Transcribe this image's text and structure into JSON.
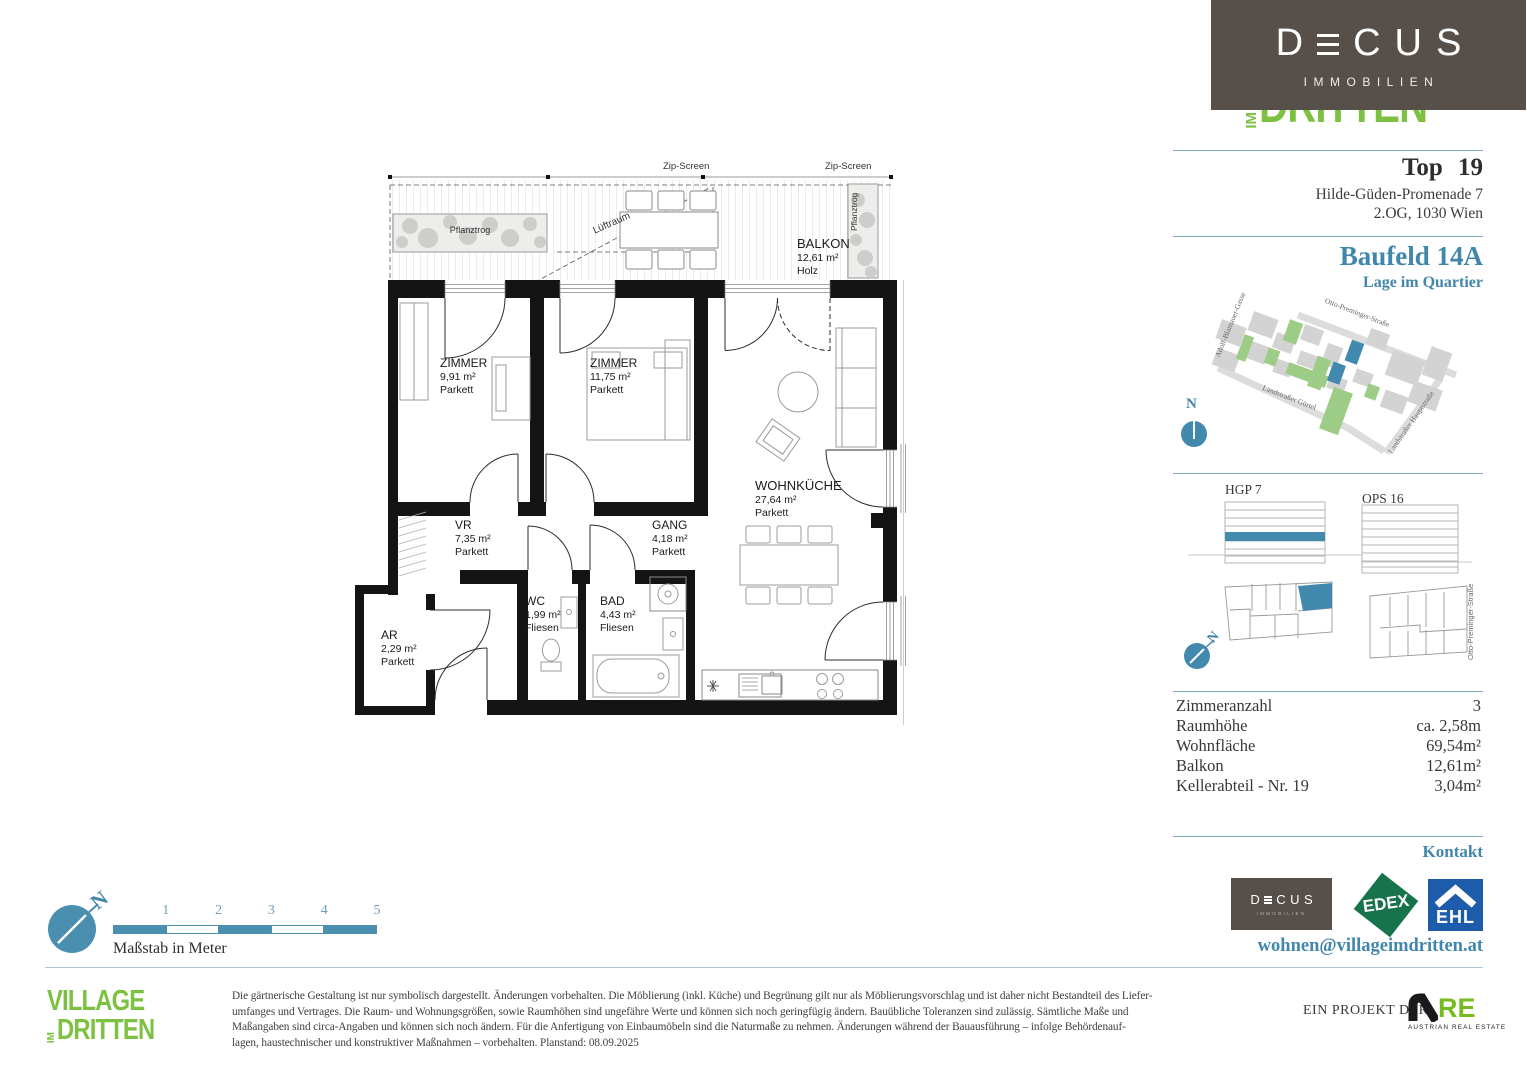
{
  "decus_logo": {
    "prefix": "D",
    "suffix_c": "C",
    "suffix_u": "U",
    "suffix_s": "S",
    "name": "DECUS",
    "sub": "IMMOBILIEN"
  },
  "village_logo": {
    "village": "VILLAGE",
    "im": "IM",
    "dritten": "DRITTEN"
  },
  "header": {
    "top_label": "Top 19",
    "address_line1": "Hilde-Güden-Promenade 7",
    "address_line2": "2.OG, 1030 Wien"
  },
  "quartier": {
    "title": "Baufeld 14A",
    "subtitle": "Lage im Quartier",
    "compass_n": "N",
    "streets": {
      "adolf": "Adolf-Blamauer-Gasse",
      "otto": "Otto-Preminger-Straße",
      "guertel": "Landstraßer Gürtel",
      "hauptstrasse": "Landstraßer Hauptstraße"
    }
  },
  "buildings": {
    "left_label": "HGP 7",
    "right_label": "OPS 16",
    "street_label": "Otto-Preminger-Straße",
    "compass_n": "N"
  },
  "facts": {
    "rows": [
      {
        "label": "Zimmeranzahl",
        "value": "3"
      },
      {
        "label": "Raumhöhe",
        "value": "ca. 2,58m"
      },
      {
        "label": "Wohnfläche",
        "value": "69,54m²"
      },
      {
        "label": "Balkon",
        "value": "12,61m²"
      },
      {
        "label": "Kellerabteil - Nr. 19",
        "value": "3,04m²"
      }
    ]
  },
  "kontakt": {
    "title": "Kontakt",
    "email": "wohnen@villageimdritten.at",
    "edex_label": "EDEX",
    "ehl_label": "EHL"
  },
  "plan": {
    "zip_screen_left": "Zip-Screen",
    "zip_screen_right": "Zip-Screen",
    "pflanztrog_left": "Pflanztrog",
    "pflanztrog_right": "Pflanztrog",
    "luftraum": "Lüftraum",
    "rooms": [
      {
        "name": "ZIMMER",
        "area": "9,91 m²",
        "floor": "Parkett"
      },
      {
        "name": "ZIMMER",
        "area": "11,75 m²",
        "floor": "Parkett"
      },
      {
        "name": "WOHNKÜCHE",
        "area": "27,64 m²",
        "floor": "Parkett"
      },
      {
        "name": "VR",
        "area": "7,35 m²",
        "floor": "Parkett"
      },
      {
        "name": "GANG",
        "area": "4,18 m²",
        "floor": "Parkett"
      },
      {
        "name": "WC",
        "area": "1,99 m²",
        "floor": "Fliesen"
      },
      {
        "name": "BAD",
        "area": "4,43 m²",
        "floor": "Fliesen"
      },
      {
        "name": "AR",
        "area": "2,29 m²",
        "floor": "Parkett"
      },
      {
        "name": "BALKON",
        "area": "12,61 m²",
        "floor": "Holz"
      }
    ]
  },
  "scalebar": {
    "ticks": [
      "1",
      "2",
      "3",
      "4",
      "5"
    ],
    "caption": "Maßstab in Meter",
    "compass_n": "N"
  },
  "footer": {
    "disclaimer_lines": [
      "Die gärtnerische Gestaltung ist nur symbolisch dargestellt. Änderungen vorbehalten. Die Möblierung (inkl. Küche) und Begrünung gilt nur als Möblierungsvorschlag und ist daher nicht Bestandteil des Liefer-",
      "umfanges und Vertrages. Die Raum- und Wohnungsgrößen, sowie Raumhöhen sind ungefähre Werte und können sich noch geringfügig ändern. Bauübliche Toleranzen sind zulässig. Sämtliche Maße und",
      "Maßangaben sind circa-Angaben und können sich noch ändern. Für die Anfertigung von Einbaumöbeln sind die Naturmaße zu nehmen. Änderungen während der Bauausführung – infolge Behördenauf-",
      "lagen, haustechnischer und konstruktiver Maßnahmen – vorbehalten. Planstand: 08.09.2025"
    ],
    "project_label": "EIN PROJEKT DER",
    "are_re": "RE",
    "are_sub": "AUSTRIAN REAL ESTATE"
  }
}
